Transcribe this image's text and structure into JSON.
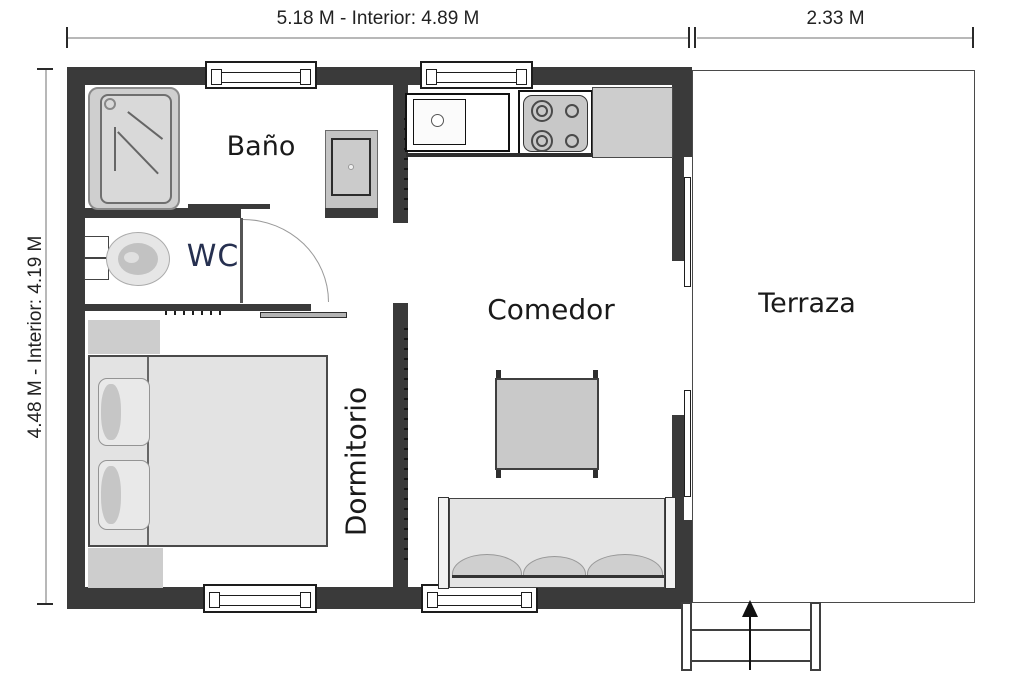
{
  "plan": {
    "dimensions": {
      "top_main": "5.18 M - Interior: 4.89 M",
      "top_terrace": "2.33 M",
      "left_side": "4.48 M - Interior: 4.19 M"
    },
    "rooms": {
      "bathroom": "Baño",
      "wc": "WC",
      "bedroom": "Dormitorio",
      "dining_room": "Comedor",
      "terrace": "Terraza"
    },
    "colors": {
      "wall": "#3a3a3a",
      "furniture_fill": "#d9d9d9",
      "counter_fill": "#cdcdcd",
      "wc_label": "#263050",
      "label": "#1a1a1a",
      "dimension_line": "#b8b8b8"
    }
  }
}
